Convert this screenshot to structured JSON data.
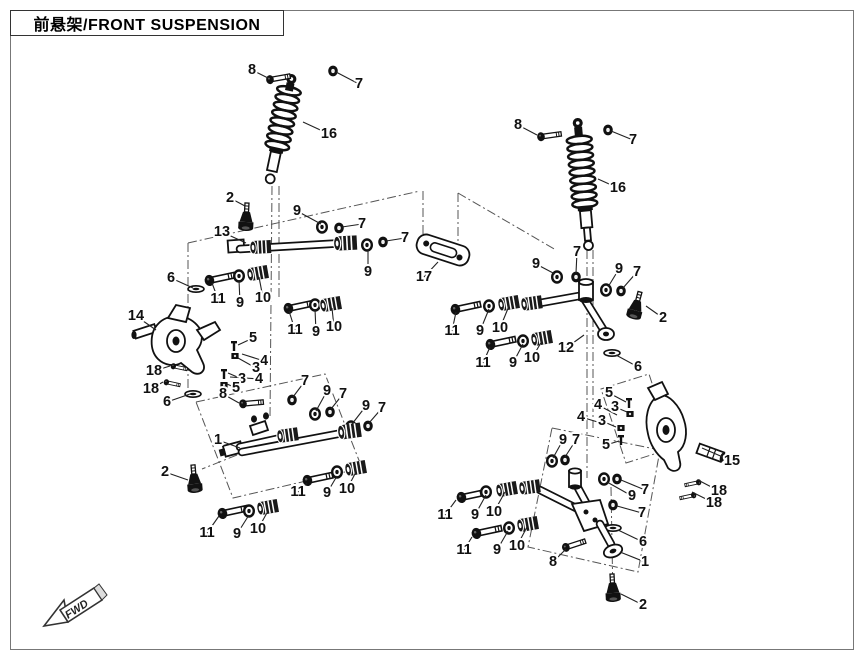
{
  "page": {
    "title": "前悬架/FRONT SUSPENSION",
    "fwd_label": "FWD"
  },
  "colors": {
    "ink": "#111111",
    "phantom": "#555555",
    "frame": "#777777"
  },
  "diagram": {
    "description": "Exploded parts view, front suspension, two assemblies",
    "callouts": [
      {
        "n": "8",
        "x": 252,
        "y": 70,
        "tx": 268,
        "ty": 78
      },
      {
        "n": "7",
        "x": 359,
        "y": 84,
        "tx": 336,
        "ty": 72
      },
      {
        "n": "16",
        "x": 329,
        "y": 134,
        "tx": 303,
        "ty": 122
      },
      {
        "n": "2",
        "x": 230,
        "y": 198,
        "tx": 245,
        "ty": 206
      },
      {
        "n": "13",
        "x": 222,
        "y": 232,
        "tx": 246,
        "ty": 243
      },
      {
        "n": "9",
        "x": 297,
        "y": 211,
        "tx": 321,
        "ty": 224
      },
      {
        "n": "7",
        "x": 362,
        "y": 224,
        "tx": 342,
        "ty": 227
      },
      {
        "n": "7",
        "x": 405,
        "y": 238,
        "tx": 386,
        "ty": 241
      },
      {
        "n": "9",
        "x": 368,
        "y": 272,
        "tx": 368,
        "ty": 249
      },
      {
        "n": "17",
        "x": 424,
        "y": 277,
        "tx": 438,
        "ty": 262
      },
      {
        "n": "6",
        "x": 171,
        "y": 278,
        "tx": 193,
        "ty": 288
      },
      {
        "n": "11",
        "x": 218,
        "y": 299,
        "tx": 212,
        "ty": 283
      },
      {
        "n": "9",
        "x": 240,
        "y": 303,
        "tx": 239,
        "ty": 280
      },
      {
        "n": "10",
        "x": 263,
        "y": 298,
        "tx": 259,
        "ty": 277
      },
      {
        "n": "11",
        "x": 295,
        "y": 330,
        "tx": 289,
        "ty": 311
      },
      {
        "n": "9",
        "x": 316,
        "y": 332,
        "tx": 315,
        "ty": 309
      },
      {
        "n": "10",
        "x": 334,
        "y": 327,
        "tx": 332,
        "ty": 308
      },
      {
        "n": "14",
        "x": 136,
        "y": 316,
        "tx": 156,
        "ty": 330
      },
      {
        "n": "5",
        "x": 253,
        "y": 338,
        "tx": 238,
        "ty": 345
      },
      {
        "n": "4",
        "x": 264,
        "y": 361,
        "tx": 242,
        "ty": 354
      },
      {
        "n": "3",
        "x": 256,
        "y": 368,
        "tx": 238,
        "ty": 358
      },
      {
        "n": "3",
        "x": 242,
        "y": 379,
        "tx": 228,
        "ty": 373
      },
      {
        "n": "4",
        "x": 259,
        "y": 379,
        "tx": 230,
        "ty": 377
      },
      {
        "n": "5",
        "x": 236,
        "y": 388,
        "tx": 227,
        "ty": 384
      },
      {
        "n": "18",
        "x": 154,
        "y": 371,
        "tx": 170,
        "ty": 366
      },
      {
        "n": "18",
        "x": 151,
        "y": 389,
        "tx": 163,
        "ty": 382
      },
      {
        "n": "6",
        "x": 167,
        "y": 402,
        "tx": 190,
        "ty": 394
      },
      {
        "n": "8",
        "x": 223,
        "y": 394,
        "tx": 239,
        "ty": 403
      },
      {
        "n": "7",
        "x": 305,
        "y": 381,
        "tx": 293,
        "ty": 397
      },
      {
        "n": "1",
        "x": 218,
        "y": 440,
        "tx": 240,
        "ty": 448
      },
      {
        "n": "9",
        "x": 327,
        "y": 391,
        "tx": 316,
        "ty": 411
      },
      {
        "n": "7",
        "x": 343,
        "y": 394,
        "tx": 331,
        "ty": 409
      },
      {
        "n": "9",
        "x": 366,
        "y": 406,
        "tx": 352,
        "ty": 424
      },
      {
        "n": "7",
        "x": 382,
        "y": 408,
        "tx": 369,
        "ty": 423
      },
      {
        "n": "2",
        "x": 165,
        "y": 472,
        "tx": 188,
        "ty": 480
      },
      {
        "n": "11",
        "x": 298,
        "y": 492,
        "tx": 307,
        "ty": 483
      },
      {
        "n": "9",
        "x": 327,
        "y": 493,
        "tx": 337,
        "ty": 476
      },
      {
        "n": "10",
        "x": 347,
        "y": 489,
        "tx": 356,
        "ty": 472
      },
      {
        "n": "11",
        "x": 207,
        "y": 533,
        "tx": 219,
        "ty": 516
      },
      {
        "n": "9",
        "x": 237,
        "y": 534,
        "tx": 249,
        "ty": 515
      },
      {
        "n": "10",
        "x": 258,
        "y": 529,
        "tx": 268,
        "ty": 511
      },
      {
        "n": "8",
        "x": 518,
        "y": 125,
        "tx": 537,
        "ty": 135
      },
      {
        "n": "7",
        "x": 633,
        "y": 140,
        "tx": 611,
        "ty": 131
      },
      {
        "n": "16",
        "x": 618,
        "y": 188,
        "tx": 598,
        "ty": 179
      },
      {
        "n": "9",
        "x": 536,
        "y": 264,
        "tx": 555,
        "ty": 274
      },
      {
        "n": "7",
        "x": 577,
        "y": 252,
        "tx": 576,
        "ty": 273
      },
      {
        "n": "9",
        "x": 619,
        "y": 269,
        "tx": 608,
        "ty": 287
      },
      {
        "n": "7",
        "x": 637,
        "y": 272,
        "tx": 623,
        "ty": 288
      },
      {
        "n": "2",
        "x": 663,
        "y": 318,
        "tx": 646,
        "ty": 306
      },
      {
        "n": "12",
        "x": 566,
        "y": 348,
        "tx": 584,
        "ty": 335
      },
      {
        "n": "6",
        "x": 638,
        "y": 367,
        "tx": 616,
        "ty": 355
      },
      {
        "n": "11",
        "x": 452,
        "y": 331,
        "tx": 456,
        "ty": 312
      },
      {
        "n": "9",
        "x": 480,
        "y": 331,
        "tx": 489,
        "ty": 309
      },
      {
        "n": "10",
        "x": 500,
        "y": 328,
        "tx": 509,
        "ty": 306
      },
      {
        "n": "11",
        "x": 483,
        "y": 363,
        "tx": 490,
        "ty": 347
      },
      {
        "n": "9",
        "x": 513,
        "y": 363,
        "tx": 523,
        "ty": 344
      },
      {
        "n": "10",
        "x": 532,
        "y": 358,
        "tx": 542,
        "ty": 341
      },
      {
        "n": "5",
        "x": 609,
        "y": 393,
        "tx": 626,
        "ty": 402
      },
      {
        "n": "3",
        "x": 615,
        "y": 407,
        "tx": 627,
        "ty": 412
      },
      {
        "n": "4",
        "x": 598,
        "y": 405,
        "tx": 617,
        "ty": 415
      },
      {
        "n": "4",
        "x": 581,
        "y": 417,
        "tx": 601,
        "ty": 423
      },
      {
        "n": "3",
        "x": 602,
        "y": 421,
        "tx": 616,
        "ty": 427
      },
      {
        "n": "5",
        "x": 606,
        "y": 445,
        "tx": 619,
        "ty": 441
      },
      {
        "n": "15",
        "x": 732,
        "y": 461,
        "tx": 702,
        "ty": 448
      },
      {
        "n": "18",
        "x": 719,
        "y": 491,
        "tx": 698,
        "ty": 480
      },
      {
        "n": "18",
        "x": 714,
        "y": 503,
        "tx": 692,
        "ty": 492
      },
      {
        "n": "7",
        "x": 645,
        "y": 490,
        "tx": 621,
        "ty": 480
      },
      {
        "n": "9",
        "x": 632,
        "y": 496,
        "tx": 607,
        "ty": 482
      },
      {
        "n": "7",
        "x": 642,
        "y": 513,
        "tx": 617,
        "ty": 506
      },
      {
        "n": "6",
        "x": 643,
        "y": 542,
        "tx": 618,
        "ty": 530
      },
      {
        "n": "1",
        "x": 645,
        "y": 562,
        "tx": 620,
        "ty": 552
      },
      {
        "n": "2",
        "x": 643,
        "y": 605,
        "tx": 621,
        "ty": 594
      },
      {
        "n": "8",
        "x": 553,
        "y": 562,
        "tx": 566,
        "ty": 549
      },
      {
        "n": "9",
        "x": 563,
        "y": 440,
        "tx": 553,
        "ty": 458
      },
      {
        "n": "7",
        "x": 576,
        "y": 440,
        "tx": 565,
        "ty": 457
      },
      {
        "n": "11",
        "x": 445,
        "y": 515,
        "tx": 456,
        "ty": 500
      },
      {
        "n": "9",
        "x": 475,
        "y": 515,
        "tx": 486,
        "ty": 495
      },
      {
        "n": "10",
        "x": 494,
        "y": 512,
        "tx": 505,
        "ty": 492
      },
      {
        "n": "11",
        "x": 464,
        "y": 550,
        "tx": 472,
        "ty": 537
      },
      {
        "n": "9",
        "x": 497,
        "y": 550,
        "tx": 508,
        "ty": 531
      },
      {
        "n": "10",
        "x": 517,
        "y": 546,
        "tx": 527,
        "ty": 527
      }
    ]
  }
}
